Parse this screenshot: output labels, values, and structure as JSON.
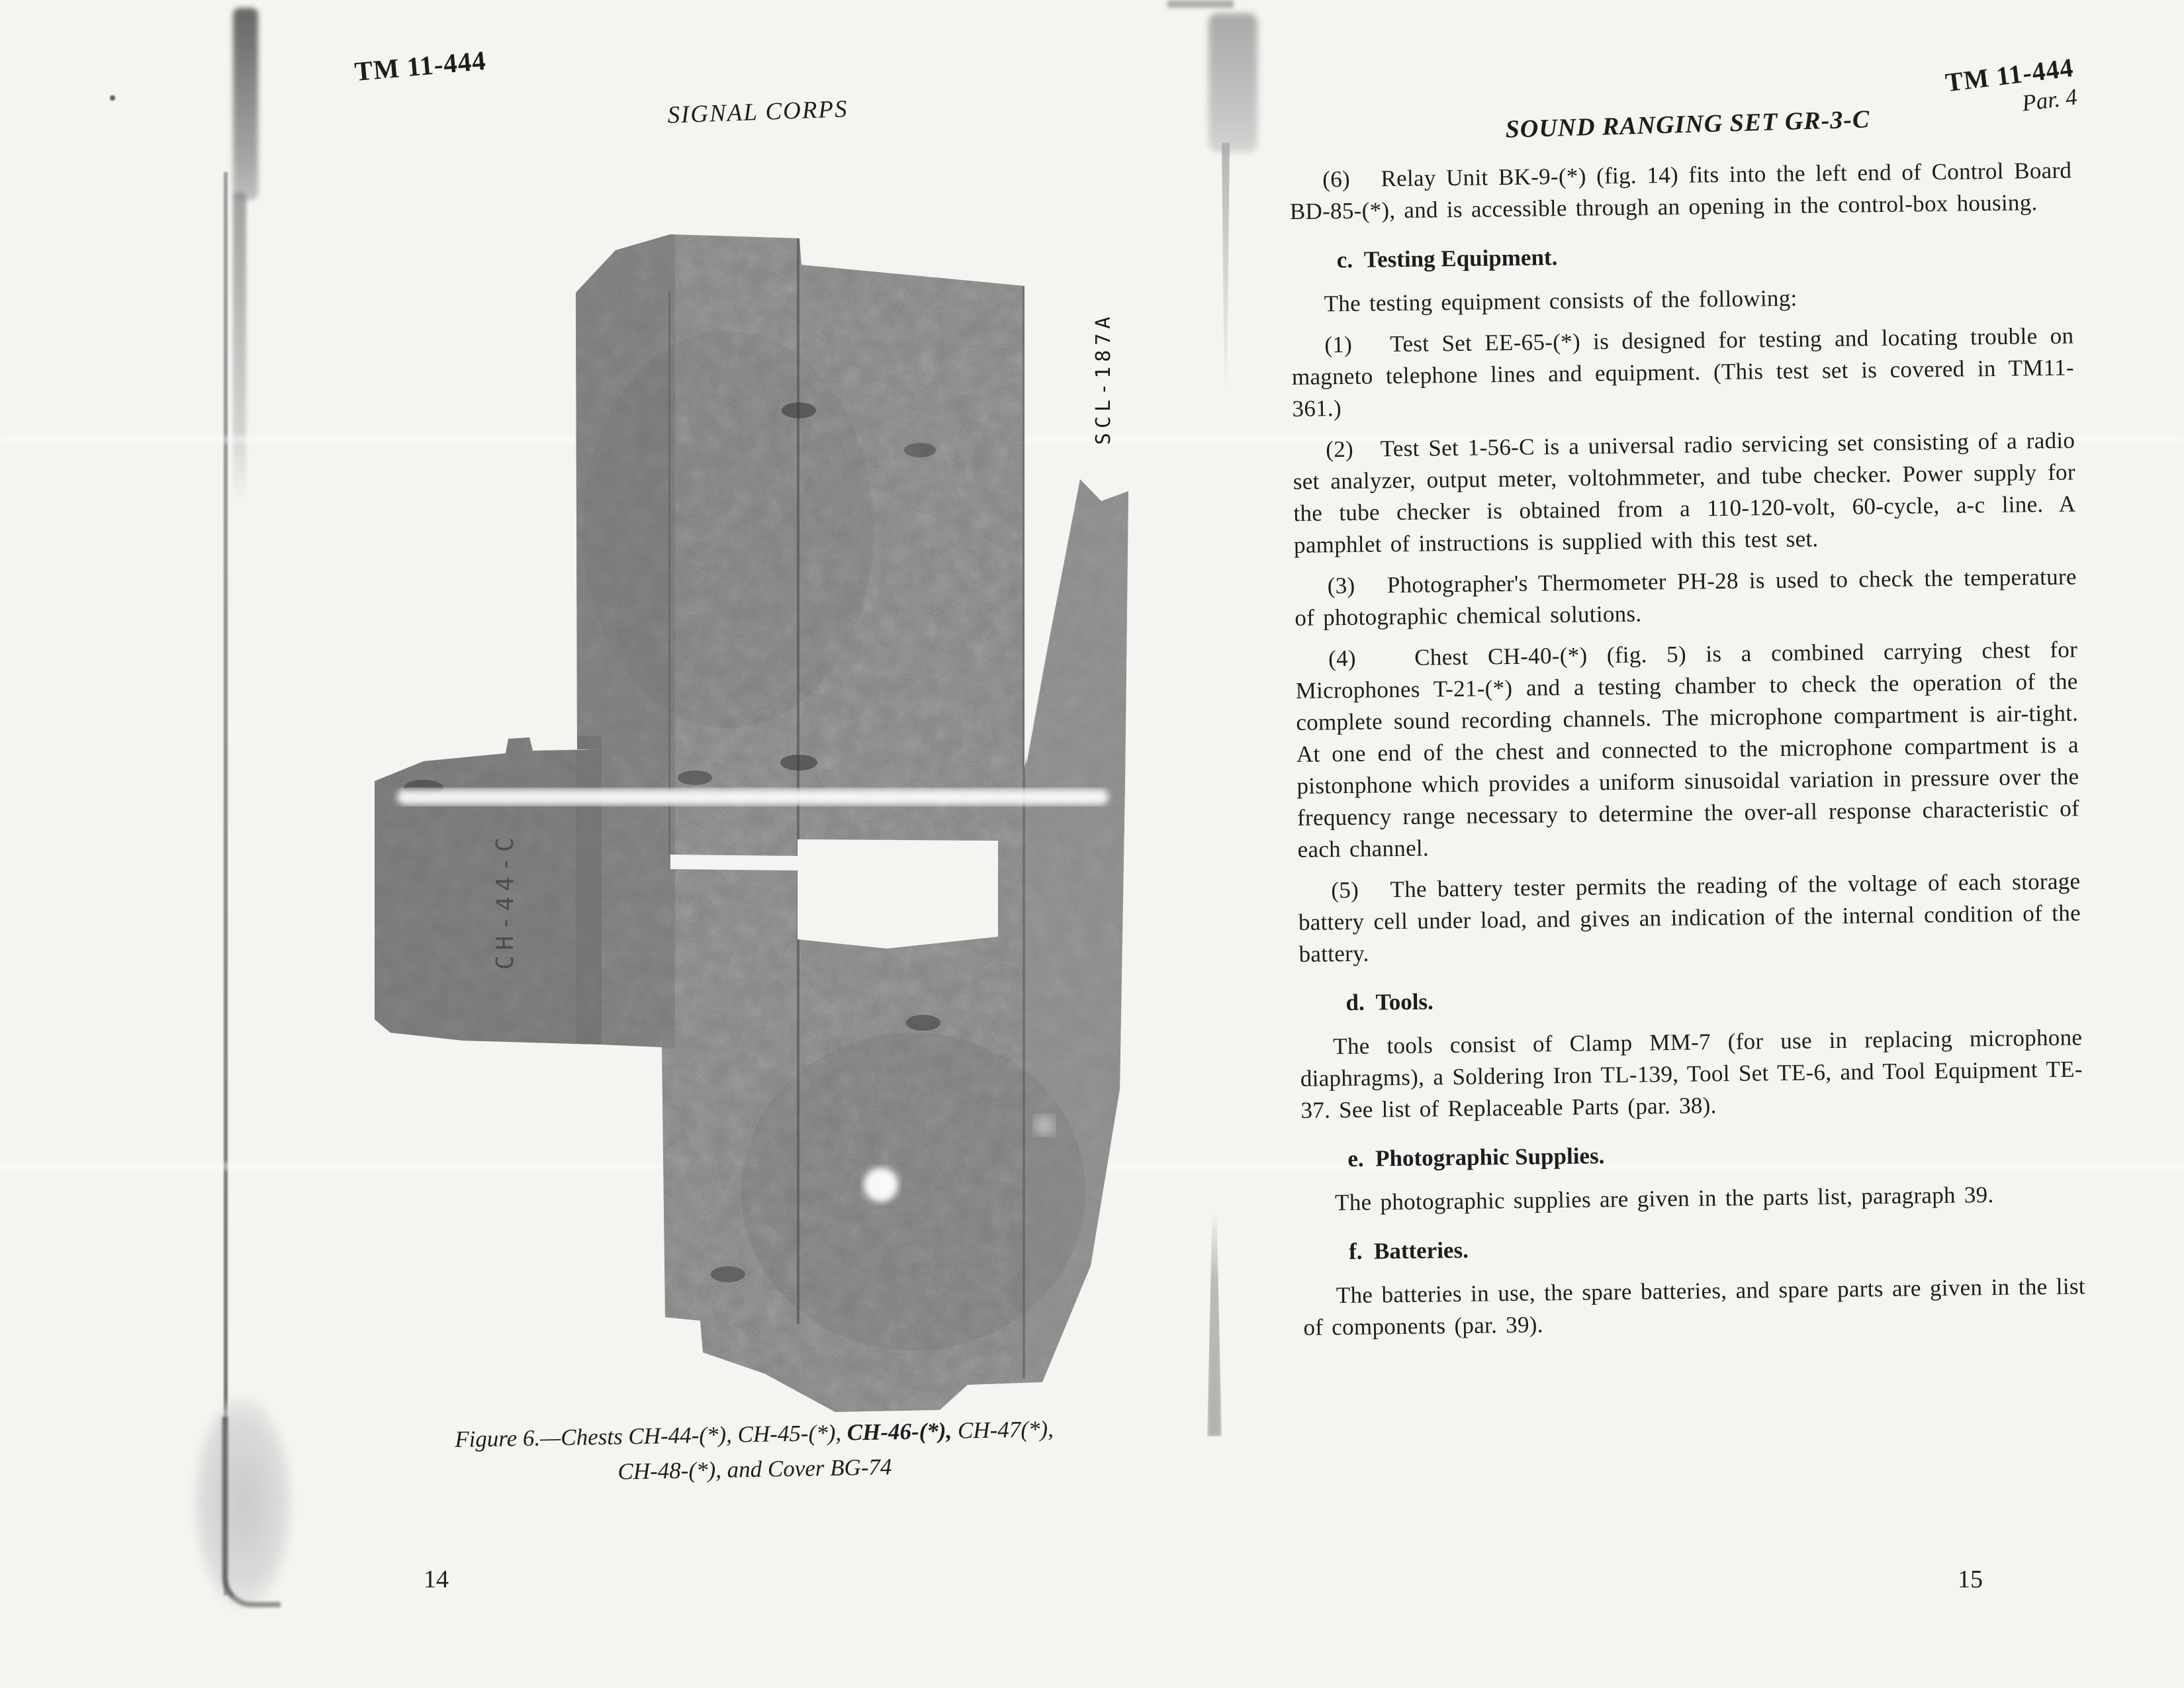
{
  "colors": {
    "page_bg": "#f5f4f0",
    "ink": "#1d1d1d",
    "photo_gray": "#7b7b7b"
  },
  "left_page": {
    "header_tm": "TM 11-444",
    "header_corps": "SIGNAL CORPS",
    "figure": {
      "photo_label": "SCL-187A",
      "stencil_text": "CH-44-C",
      "caption_line1_pre": "Figure 6.—Chests CH-44-(*), CH-45-(*), ",
      "caption_line1_bold": "CH-46-(*),",
      "caption_line1_post": " CH-47(*),",
      "caption_line2": "CH-48-(*), and Cover BG-74"
    },
    "page_number": "14"
  },
  "right_page": {
    "header_tm": "TM 11-444",
    "header_par": "Par. 4",
    "title": "SOUND RANGING SET GR-3-C",
    "blocks": [
      {
        "type": "para",
        "text": "(6)   Relay Unit BK-9-(*) (fig. 14) fits into the left end of Control Board BD-85-(*), and is accessible through an opening in the control-box housing."
      },
      {
        "type": "heading",
        "text": "c.  Testing Equipment."
      },
      {
        "type": "para",
        "text": "The testing equipment consists of the following:"
      },
      {
        "type": "para",
        "text": "(1)   Test Set EE-65-(*) is designed for testing and locating trouble on magneto telephone lines and equipment. (This test set is covered in TM11-361.)"
      },
      {
        "type": "para",
        "text": "(2)   Test Set 1-56-C is a universal radio servicing set consisting of a radio set analyzer, output meter, voltohmmeter, and tube checker. Power supply for the tube checker is obtained from a 110-120-volt, 60-cycle, a-c line. A pamphlet of instructions is supplied with this test set."
      },
      {
        "type": "para",
        "text": "(3)   Photographer's Thermometer PH-28 is used to check the temperature of photographic chemical solutions."
      },
      {
        "type": "para",
        "text": "(4)   Chest CH-40-(*) (fig. 5) is a combined carrying chest for Microphones T-21-(*) and a testing chamber to check the operation of the complete sound recording channels. The microphone compartment is air-tight. At one end of the chest and connected to the microphone compartment is a pistonphone which provides a uniform sinusoidal variation in pressure over the frequency range necessary to determine the over-all response characteristic of each channel."
      },
      {
        "type": "para",
        "text": "(5)   The battery tester permits the reading of the voltage of each storage battery cell under load, and gives an indication of the internal condition of the battery."
      },
      {
        "type": "heading",
        "text": "d.  Tools."
      },
      {
        "type": "para",
        "text": "The tools consist of Clamp MM-7 (for use in replacing microphone diaphragms), a Soldering Iron TL-139, Tool Set TE-6, and Tool Equipment TE-37. See list of Replaceable Parts (par. 38)."
      },
      {
        "type": "heading",
        "text": "e.  Photographic Supplies."
      },
      {
        "type": "para",
        "text": "The photographic supplies are given in the parts list, paragraph 39."
      },
      {
        "type": "heading",
        "text": "f.  Batteries."
      },
      {
        "type": "para",
        "text": "The batteries in use, the spare batteries, and spare parts are given in the list of components (par. 39)."
      }
    ],
    "page_number": "15"
  }
}
